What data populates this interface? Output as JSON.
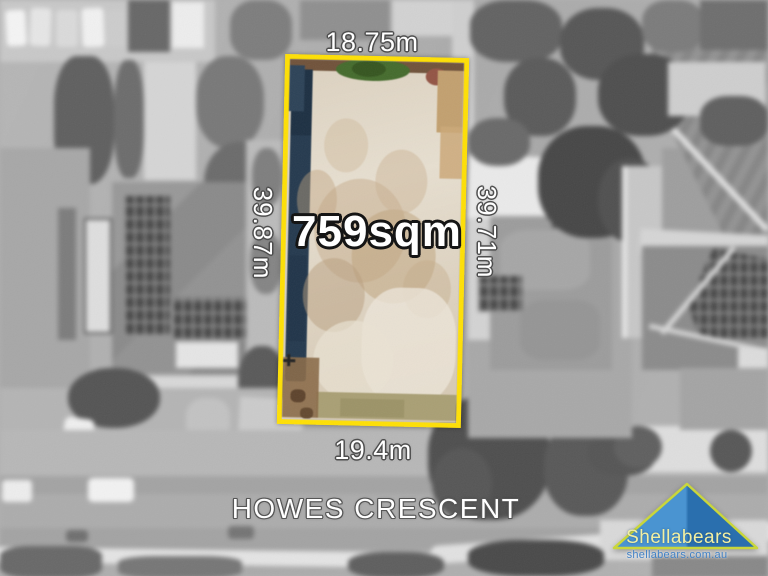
{
  "lot": {
    "area": "759sqm",
    "top_boundary": "18.75m",
    "left_boundary": "39.87m",
    "right_boundary": "39.71m",
    "bottom_boundary": "19.4m"
  },
  "street": {
    "name": "HOWES CRESCENT"
  },
  "branding": {
    "agency_name": "Shellabears",
    "website": "shellabears.com.au"
  },
  "colors": {
    "lot_outline": "#ffe003",
    "logo_triangle_light": "#4a94d1",
    "logo_triangle_dark": "#2a6fae",
    "logo_trim": "#c9d63b",
    "logo_text": "#f2efa2",
    "website_text": "#4181c5",
    "label_text": "#ffffff"
  }
}
